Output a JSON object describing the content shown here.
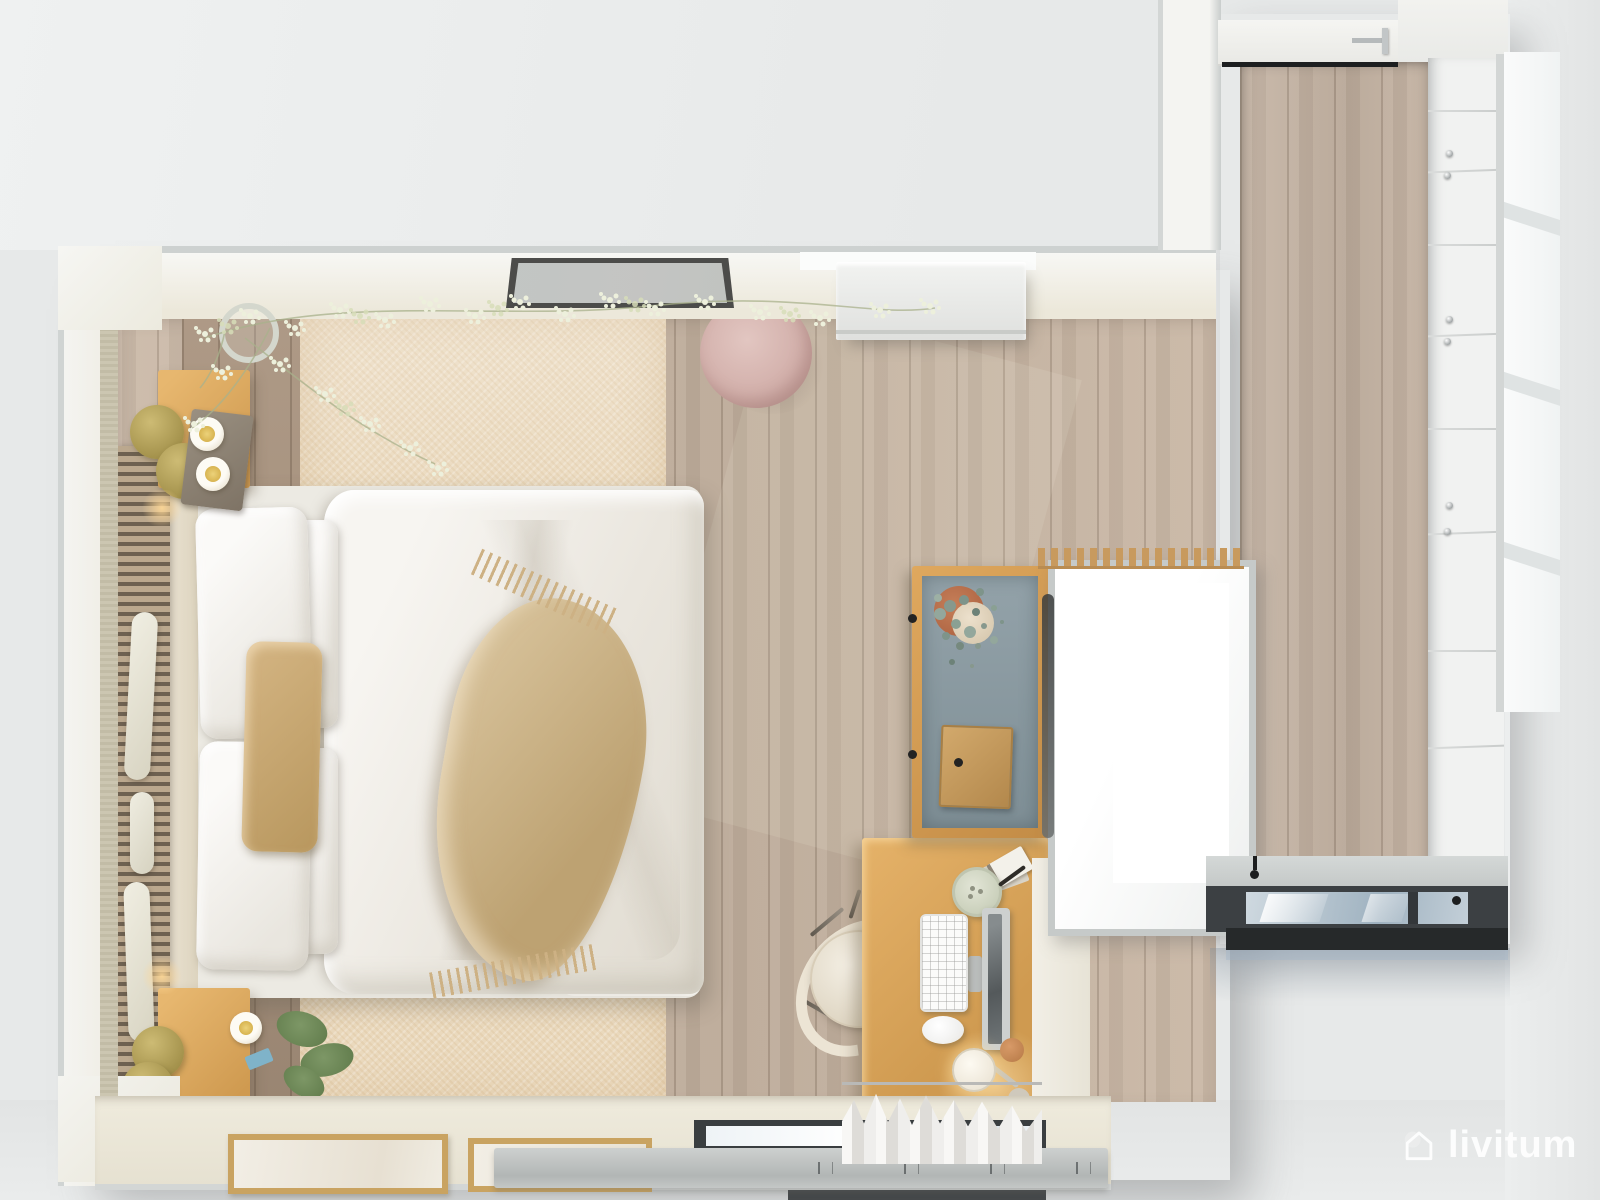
{
  "scene": {
    "title": "Top-down 3D render of a bedroom with desk nook and walk-in wardrobe corridor",
    "view": "bird's-eye floor-plan rendering, no UI text visible"
  },
  "watermark": {
    "text": "livitum",
    "icon": "house-icon",
    "color": "#ffffff"
  },
  "palette": {
    "background": "#e7e9e9",
    "wall_white": "#f5f5f2",
    "wall_edge_gray": "#cbd0cf",
    "oak_floor": "#c7b4a1",
    "walnut_floor": "#a7917c",
    "rug_beige": "#ead9bd",
    "bedding_white": "#f2efe9",
    "throw_tan": "#c9ae7e",
    "accent_pillow_tan": "#c2a26b",
    "oak_furniture": "#d9a85f",
    "brass": "#b3a058",
    "pouf_pink": "#d8b8b2",
    "hutch_interior_slate": "#8b9aa1",
    "window_glass": "#b9c7d3",
    "dark_window_frame": "#3d4144"
  },
  "bedroom": {
    "objects": [
      "double bed with white duvet and four white pillows",
      "tan accent pillow",
      "fringed tan throw blanket",
      "slatted headboard wall panel with white vases",
      "oak nightstand with tray and two cups",
      "oak nightstand with plant and cup",
      "brass disc side tables",
      "gypsophila branches in a vase",
      "dark-framed leaning mirror",
      "round pink pouf",
      "white dresser",
      "beige area rug over oak floor",
      "oak desk with keyboard, mouse, portrait monitor, candle, books and lit lamp",
      "glass-front hutch with eucalyptus vase and wooden box",
      "white desk chair",
      "white gathered curtain over low window",
      "gray radiator strip under window",
      "two leaning picture frames"
    ]
  },
  "corridor": {
    "objects": [
      "white entry door with steel handle",
      "built-in white wardrobe drawer fronts with knobs",
      "oak plank floor",
      "low picture window with dark frame and glass",
      "bright exterior windows along right wall"
    ]
  }
}
